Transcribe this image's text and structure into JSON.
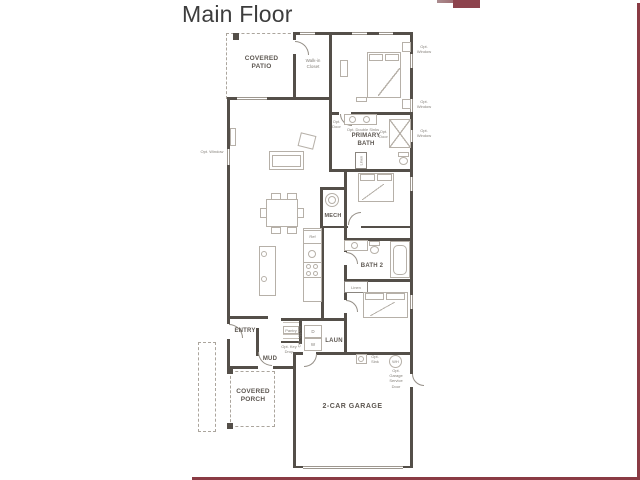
{
  "title": "Main Floor",
  "plan": {
    "rooms": {
      "covered_patio": "COVERED PATIO",
      "walk_in_closet": "Walk-in Closet",
      "primary_bath": "PRIMARY BATH",
      "mech": "MECH",
      "bath2": "BATH 2",
      "entry": "ENTRY",
      "mud": "MUD",
      "laun": "LAUN",
      "covered_porch": "COVERED PORCH",
      "garage": "2-CAR GARAGE"
    },
    "fixtures": {
      "ref": "Ref",
      "pantry": "Pantry",
      "linen": "Linen",
      "washer": "W",
      "dryer": "D",
      "water_heater": "WH"
    },
    "options": {
      "opt_window": "Opt. Window",
      "opt_door": "Opt. Door",
      "opt_double_sinks": "Opt. Double Sinks",
      "opt_key_drop": "Opt. Key Drop",
      "opt_uppers": "Opt. Uppers",
      "opt_sink": "Opt. Sink",
      "opt_garage_service_door": "Opt. Garage Service Door"
    },
    "colors": {
      "accent": "#8a3b44",
      "wall": "#544f49"
    }
  }
}
